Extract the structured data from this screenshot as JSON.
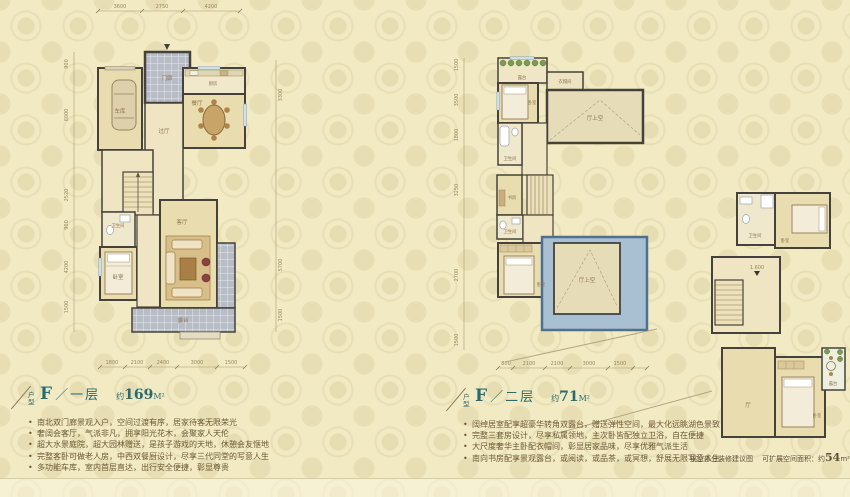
{
  "palette": {
    "background": "#f1eac3",
    "title_teal": "#2a6b72",
    "body_text": "#6b5836",
    "wall": "#46423b",
    "room_beige": "#e9dcae",
    "tile_gray": "#b7bcc5",
    "roof_blue": "#a9bfd2",
    "plant_green": "#7d9a55"
  },
  "sections": {
    "s1": {
      "prefix": "户型",
      "letter": "F",
      "sep": "／",
      "floor": "一层",
      "area_about": "约",
      "area_num": "169",
      "area_unit": "M²",
      "bullets": [
        "南北双门廊景观入户，空间过渡有序，居家待客无限荣光",
        "奢阔会客厅，气派非凡，拥享阳光花木，会聚家人天伦",
        "超大水景庭院，超大园林赠送，是孩子游戏的天地，休憩会友惬地",
        "完整客卧可做老人房，中西双餐厨设计，尽享三代同堂的写意人生",
        "多功能车库，室内首层直达，出行安全便捷，彰显尊贵"
      ]
    },
    "s2": {
      "prefix": "户型",
      "letter": "F",
      "sep": "／",
      "floor": "二层",
      "area_about": "约",
      "area_num": "71",
      "area_unit": "M²",
      "bullets": [
        "阔绰居室配享超豪华转角双露台，赠送弹性空间，最大化远眺湖色景致",
        "完整三套房设计，尽享私属领地，主次卧皆配独立卫浴，自在便捷",
        "大尺度奢华主卧配衣帽间，彰显居家品味，尽享优雅气派生活",
        "南向书房配享景观露台，或阅读，或品茶，或冥想，舒展无限写意人生"
      ]
    }
  },
  "caption": {
    "label": "挑空部分装修建议图",
    "expand_prefix": "可扩展空间面积：约",
    "expand_num": "54",
    "expand_unit": "m²"
  },
  "plan1": {
    "rooms": {
      "porch": "门廊",
      "garage": "车库",
      "kitchen": "厨房",
      "dining": "餐厅",
      "hall": "过厅",
      "bath": "卫生间",
      "bedroom": "卧室",
      "living": "客厅",
      "terrace": "露台"
    },
    "dims_top": [
      "3600",
      "2750",
      "4200"
    ],
    "dims_bottom": [
      "1800",
      "2100",
      "2400",
      "3000",
      "1500"
    ],
    "dims_left": [
      "900",
      "6000",
      "2520",
      "900",
      "4200",
      "1500"
    ],
    "dims_right": [
      "3300",
      "5700",
      "1500"
    ]
  },
  "plan2": {
    "rooms": {
      "balcony": "露台",
      "bedroom1": "卧室",
      "closet": "衣帽间",
      "void1": "厅上空",
      "bath1": "卫生间",
      "study": "书房",
      "bath2": "卫生间",
      "bedroom2": "卧室",
      "void2": "厅上空"
    },
    "dims_left": [
      "1500",
      "3500",
      "1800",
      "3250",
      "2700",
      "1500"
    ],
    "dims_bottom": [
      "800",
      "2100",
      "2100",
      "3000",
      "1500"
    ]
  },
  "plan3": {
    "rooms": {
      "bath": "卫生间",
      "bedroom1": "卧室",
      "hall": "厅",
      "bedroom2": "卧室",
      "terrace": "露台"
    },
    "elevation": "1.600"
  }
}
